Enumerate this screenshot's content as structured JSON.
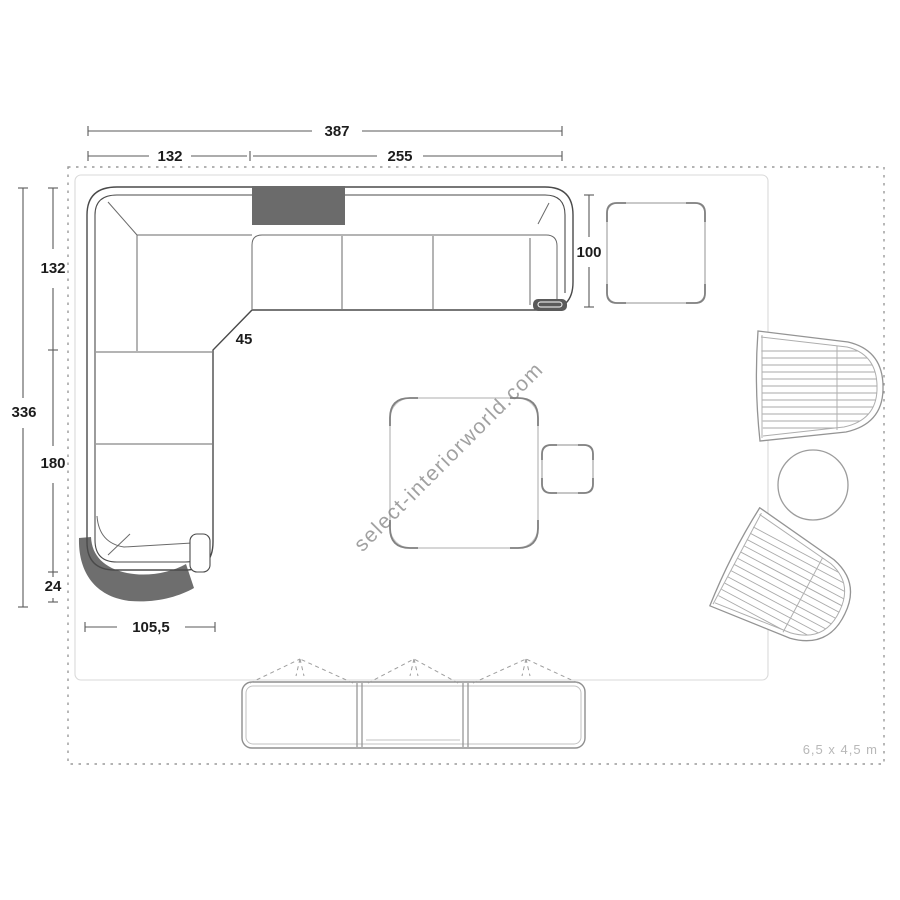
{
  "watermark": "select-interiorworld.com",
  "room": {
    "size_label": "6,5 x 4,5 m"
  },
  "dims": {
    "total_width": "387",
    "left_width": "132",
    "right_width": "255",
    "total_depth": "336",
    "upper_left": "132",
    "mid_left": "180",
    "lower_left": "24",
    "chamfer": "45",
    "sofa_depth": "100",
    "chaise_width": "105,5"
  },
  "colors": {
    "sofa_outline": "#4a4a4a",
    "throw_fill": "#6b6b6b",
    "shadow_fill": "#6e6e6e",
    "light_furniture_line": "#b5b5b5",
    "corner_accent": "#828282",
    "room_border": "#9a9a9a",
    "watermark_gray": "#7d7d7d",
    "room_label_gray": "#b8b8b8"
  }
}
